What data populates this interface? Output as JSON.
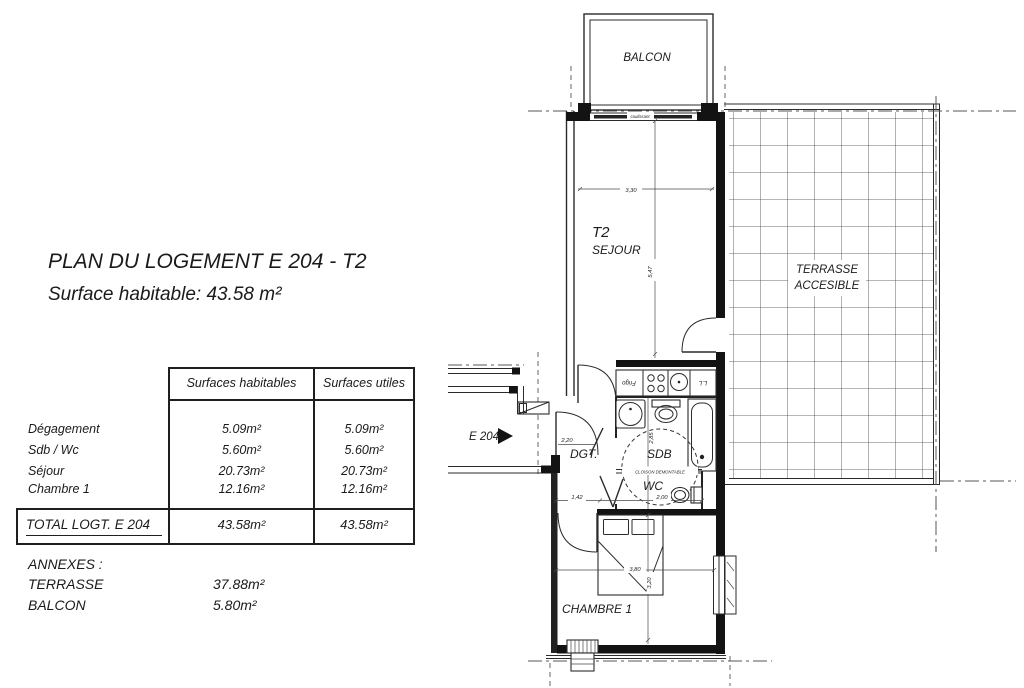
{
  "title_block": {
    "title": "PLAN DU LOGEMENT E 204 - T2",
    "subtitle": "Surface habitable: 43.58 m²"
  },
  "surface_table": {
    "columns": [
      "Surfaces habitables",
      "Surfaces utiles"
    ],
    "rows": [
      {
        "label": "Dégagement",
        "habitable": "5.09m²",
        "utile": "5.09m²"
      },
      {
        "label": "Sdb / Wc",
        "habitable": "5.60m²",
        "utile": "5.60m²"
      },
      {
        "label": "Séjour",
        "habitable": "20.73m²",
        "utile": "20.73m²"
      },
      {
        "label": "Chambre 1",
        "habitable": "12.16m²",
        "utile": "12.16m²"
      }
    ],
    "total": {
      "label": "TOTAL LOGT. E 204",
      "habitable": "43.58m²",
      "utile": "43.58m²"
    }
  },
  "annexes": {
    "heading": "ANNEXES :",
    "items": [
      {
        "label": "TERRASSE",
        "value": "37.88m²"
      },
      {
        "label": "BALCON",
        "value": "5.80m²"
      }
    ]
  },
  "plan": {
    "rooms": {
      "balcon": "BALCON",
      "sejour_type": "T2",
      "sejour": "SEJOUR",
      "terrasse_line1": "TERRASSE",
      "terrasse_line2": "ACCESIBLE",
      "degagement": "DGT.",
      "sdb": "SDB",
      "wc": "WC",
      "chambre": "CHAMBRE 1"
    },
    "labels": {
      "entrance": "E 204",
      "cloison": "CLOISON DEMONTABLE",
      "coulissant": "coulissant",
      "frigo": "Frigo",
      "lave_linge": "L.L"
    },
    "dimensions": {
      "sejour_width": "3,30",
      "sejour_height": "5,47",
      "dgt_width": "2,20",
      "dgt_depth": "1,42",
      "wc_width": "2,00",
      "sdb_height": "2,85",
      "chambre_width": "3,80",
      "chambre_height": "3,20"
    }
  },
  "colors": {
    "ink": "#1a1a1a",
    "wall": "#131313",
    "construction_line": "#555555",
    "paper": "#ffffff"
  }
}
